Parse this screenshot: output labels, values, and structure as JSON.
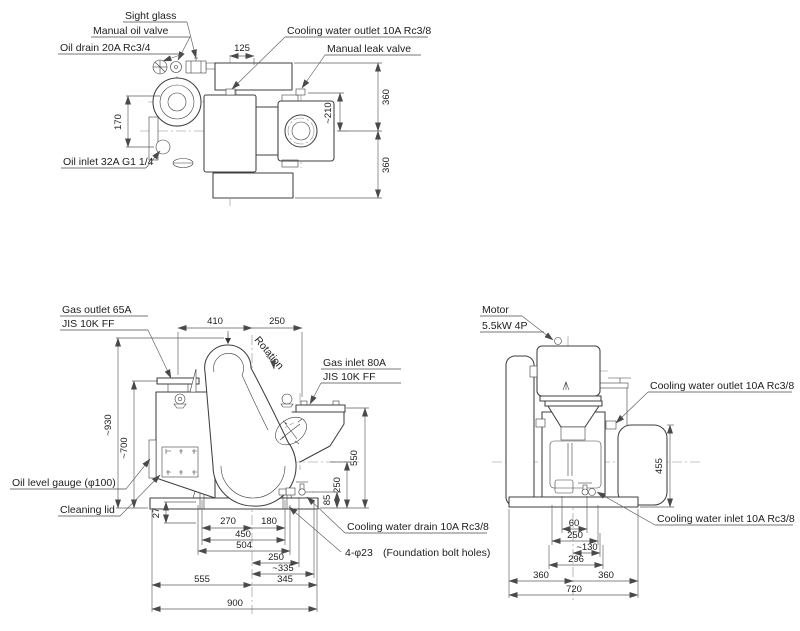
{
  "top_view": {
    "labels": {
      "sight_glass": "Sight glass",
      "manual_oil_valve": "Manual oil valve",
      "oil_drain": "Oil drain 20A Rc3/4",
      "oil_inlet": "Oil inlet 32A G1 1/4",
      "cooling_water_outlet": "Cooling water outlet 10A Rc3/8",
      "manual_leak_valve": "Manual leak valve"
    },
    "dimensions": {
      "outlet_offset": "125",
      "flange_offset": "170",
      "depth_front": "360",
      "leak_valve_offset": "~210",
      "depth_rear": "360"
    }
  },
  "front_view": {
    "labels": {
      "gas_outlet_line1": "Gas outlet 65A",
      "gas_outlet_line2": "JIS 10K FF",
      "gas_inlet_line1": "Gas inlet 80A",
      "gas_inlet_line2": "JIS 10K FF",
      "rotation": "Rotation",
      "oil_level_gauge": "Oil level gauge (φ100)",
      "cleaning_lid": "Cleaning  lid",
      "cooling_water_drain": "Cooling water drain 10A Rc3/8",
      "foundation_bolt": "4-φ23",
      "foundation_bolt_note": "(Foundation bolt holes)"
    },
    "dimensions": {
      "outlet_to_center": "410",
      "center_to_inlet": "250",
      "overall_height": "~930",
      "housing_height": "~700",
      "inlet_height": "550",
      "center_height": "250",
      "drain_height": "85",
      "foot_step": "27",
      "bolt_left_to_center": "270",
      "center_to_bolt_right": "180",
      "bolt_span": "450",
      "pump_width": "504",
      "center_to_drain": "250",
      "center_to_pipe_end": "~335",
      "base_left": "555",
      "base_right": "345",
      "base_total": "900"
    }
  },
  "side_view": {
    "labels": {
      "motor_line1": "Motor",
      "motor_line2": "5.5kW  4P",
      "cooling_water_outlet": "Cooling water outlet 10A Rc3/8",
      "cooling_water_inlet": "Cooling water inlet 10A Rc3/8"
    },
    "dimensions": {
      "cover_height": "455",
      "drain_offset": "60",
      "bolt_span": "250",
      "pipe_offset": "~130",
      "base_inner": "296",
      "base_left": "360",
      "base_right": "360",
      "base_total": "720"
    }
  }
}
